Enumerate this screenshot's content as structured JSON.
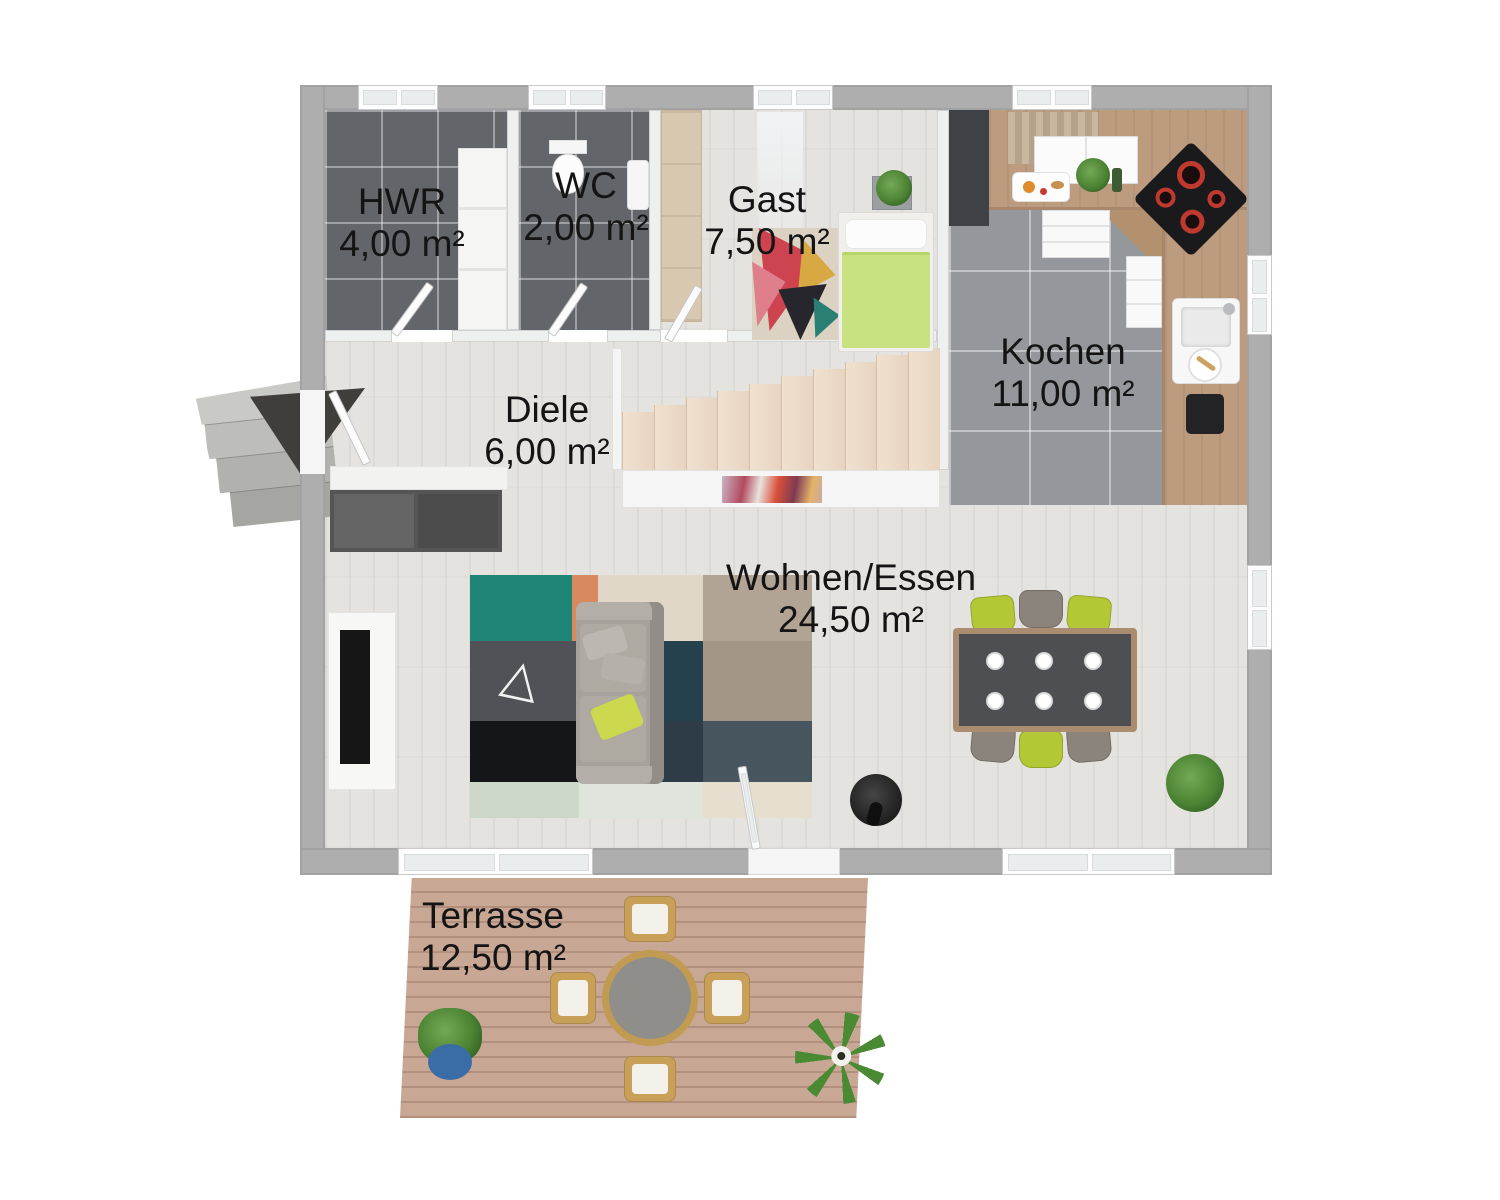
{
  "image_type": "3d-floor-plan-rendering",
  "rooms": [
    {
      "name": "HWR",
      "area": "4,00 m²"
    },
    {
      "name": "WC",
      "area": "2,00 m²"
    },
    {
      "name": "Gast",
      "area": "7,50 m²"
    },
    {
      "name": "Kochen",
      "area": "11,00 m²"
    },
    {
      "name": "Diele",
      "area": "6,00 m²"
    },
    {
      "name": "Wohnen/Essen",
      "area": "24,50 m²"
    },
    {
      "name": "Terrasse",
      "area": "12,50 m²"
    }
  ],
  "palette": {
    "background": "#ffffff",
    "outer_wall": "#aeaeae",
    "inner_wall": "#eef0f0",
    "wood_floor": "#e4e3e0",
    "tile_dark": "#62656a",
    "tile_kitchen": "#94989c",
    "counter_wood": "#bc9b7f",
    "terrace_wood": "#c9a795",
    "stair_beige": "#ecdbc8",
    "bed_green": "#c9e281",
    "accent_lime": "#b4c735",
    "label_text": "#141414"
  }
}
